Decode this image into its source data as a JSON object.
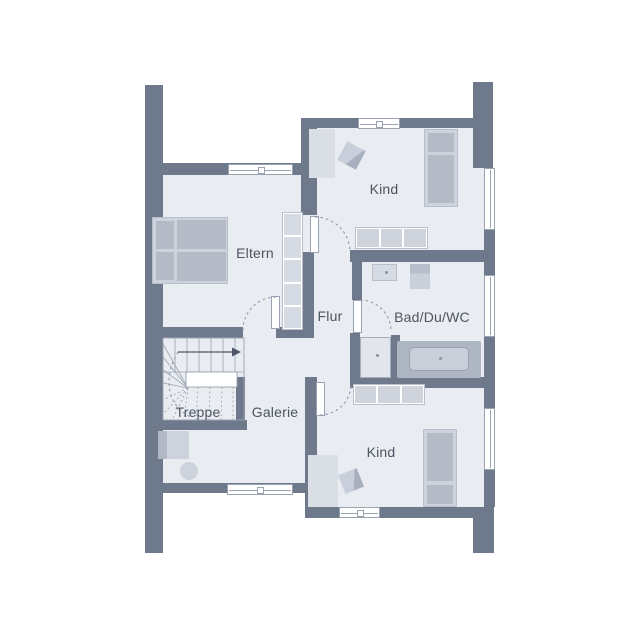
{
  "plan": {
    "title": "floor-plan-upper-storey",
    "rooms": [
      {
        "id": "eltern",
        "label": "Eltern"
      },
      {
        "id": "kind_top",
        "label": "Kind"
      },
      {
        "id": "flur",
        "label": "Flur"
      },
      {
        "id": "bad",
        "label": "Bad/Du/WC"
      },
      {
        "id": "treppe",
        "label": "Treppe"
      },
      {
        "id": "galerie",
        "label": "Galerie"
      },
      {
        "id": "kind_bottom",
        "label": "Kind"
      }
    ],
    "colors": {
      "wall": "#6e7a8c",
      "floor": "#e9ecf1",
      "outline": "#9aa3b2",
      "furn_light": "#cdd3dc",
      "furn_dark": "#b4bbc7",
      "label": "#4c5462"
    }
  }
}
